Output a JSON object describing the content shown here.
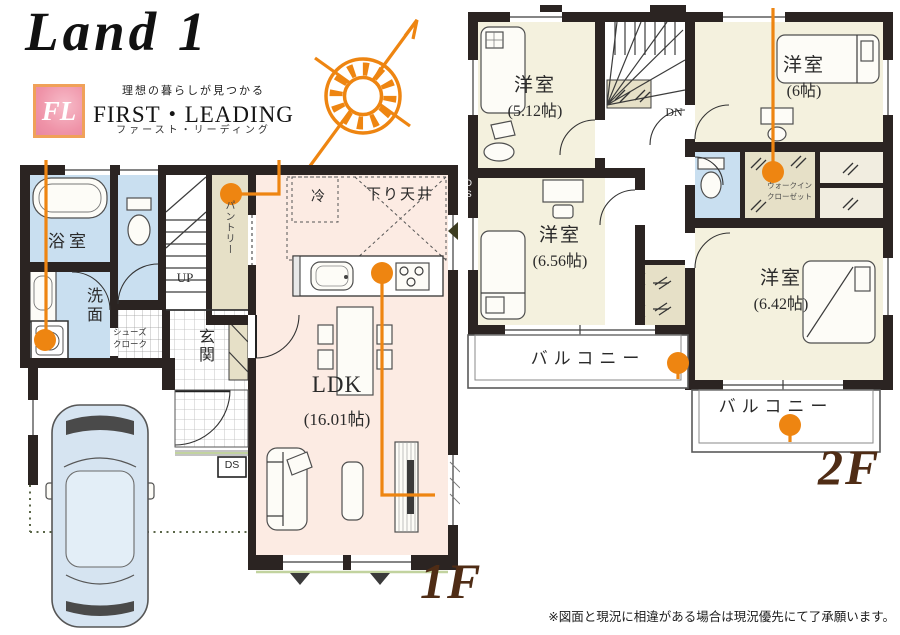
{
  "header": {
    "logo_text": "Land 1",
    "brand_initials": "FL",
    "tagline": "理想の暮らしが見つかる",
    "brand_name": "FIRST・LEADING",
    "brand_kana": "ファースト・リーディング"
  },
  "floor1": {
    "floor_label": "1F",
    "bath": "浴室",
    "washroom": "洗面",
    "pantry": "パントリー",
    "stairs_up": "UP",
    "shoes_line1": "シューズ",
    "shoes_line2": "クローク",
    "entrance": "玄関",
    "duct": "DS",
    "fridge": "冷",
    "dropped_ceiling": "下り天井",
    "ldk_name": "LDK",
    "ldk_size": "(16.01帖)"
  },
  "floor2": {
    "floor_label": "2F",
    "bedroom1_name": "洋室",
    "bedroom1_size": "(5.12帖)",
    "bedroom2_name": "洋室",
    "bedroom2_size": "(6帖)",
    "bedroom3_name": "洋室",
    "bedroom3_size": "(6.56帖)",
    "bedroom4_name": "洋室",
    "bedroom4_size": "(6.42帖)",
    "wic_line1": "ウォークイン",
    "wic_line2": "クローゼット",
    "stairs_down": "DN",
    "duct": "DS",
    "balcony1": "バルコニー",
    "balcony2": "バルコニー"
  },
  "footer": {
    "disclaimer": "※図面と現況に相違がある場合は現況優先にて了承願います。"
  },
  "colors": {
    "accent_orange": "#ee8511",
    "wall": "#2b2422",
    "water_blue": "#c9dff0",
    "room_cream": "#f4f1de",
    "ldk_pink": "#fcebe3",
    "closet_beige": "#e6e0c7",
    "label_brown": "#4f2c15",
    "logo_pink": "#ef93a8",
    "logo_border": "#f0a159"
  }
}
